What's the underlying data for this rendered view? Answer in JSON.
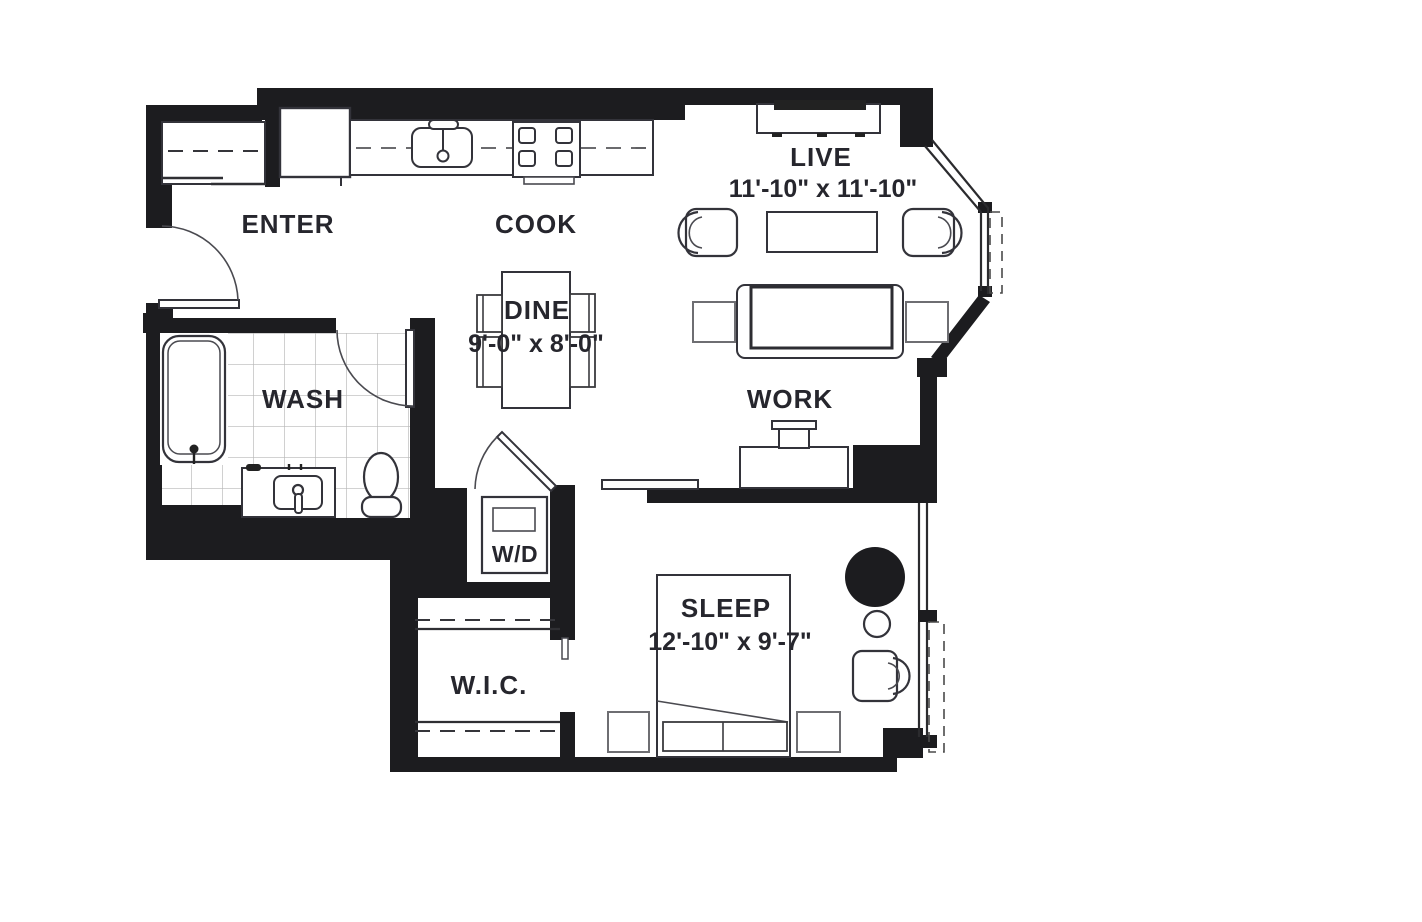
{
  "colors": {
    "background": "#ffffff",
    "wall": "#1c1c1f",
    "text": "#26262d",
    "fixture_stroke": "#33333a",
    "light_stroke": "#6e6e72",
    "tile_grid": "#b7b7b7",
    "tv_fill": "#222222"
  },
  "rooms": {
    "enter": {
      "label": "ENTER"
    },
    "cook": {
      "label": "COOK"
    },
    "live": {
      "label": "LIVE",
      "dimensions": "11'-10\" x 11'-10\""
    },
    "dine": {
      "label": "DINE",
      "dimensions": "9'-0\" x 8'-0\""
    },
    "wash": {
      "label": "WASH"
    },
    "work": {
      "label": "WORK"
    },
    "laundry": {
      "label": "W/D"
    },
    "walk_in_closet": {
      "label": "W.I.C."
    },
    "sleep": {
      "label": "SLEEP",
      "dimensions": "12'-10\" x 9'-7\""
    }
  }
}
